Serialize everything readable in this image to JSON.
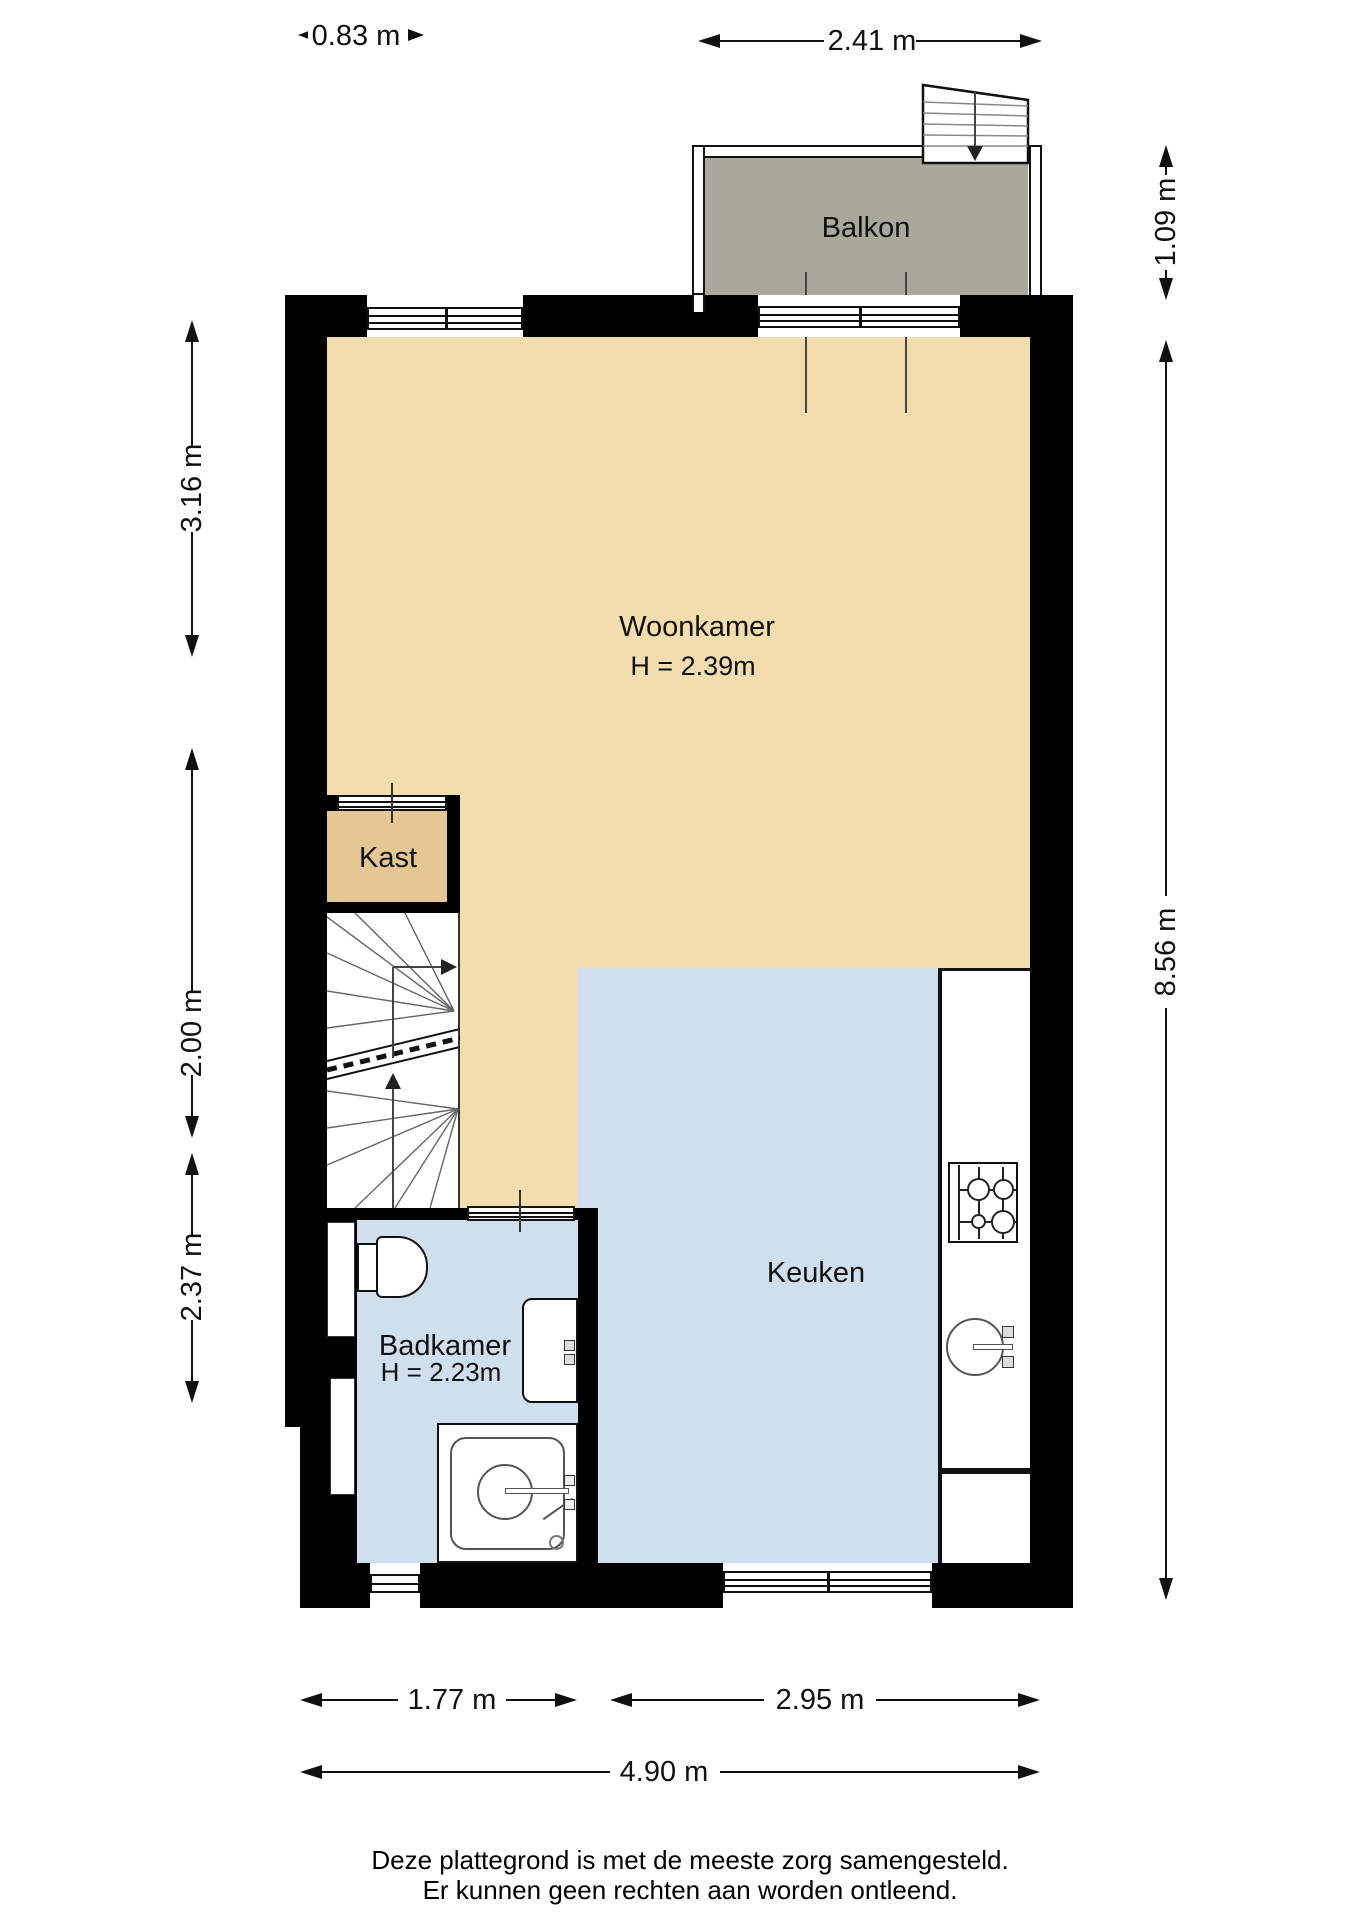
{
  "rooms": {
    "balkon": {
      "label": "Balkon"
    },
    "woonkamer": {
      "label": "Woonkamer",
      "ceiling_height": "H = 2.39m"
    },
    "kast": {
      "label": "Kast"
    },
    "keuken": {
      "label": "Keuken"
    },
    "badkamer": {
      "label": "Badkamer",
      "ceiling_height": "H = 2.23m"
    }
  },
  "dimensions": {
    "top_window_width": "0.83 m",
    "balcony_width": "2.41 m",
    "balcony_depth": "1.09 m",
    "left_upper": "3.16 m",
    "left_middle": "2.00 m",
    "left_lower": "2.37 m",
    "total_height": "8.56 m",
    "bottom_left": "1.77 m",
    "bottom_right": "2.95 m",
    "total_width": "4.90 m"
  },
  "footer": {
    "line1": "Deze plattegrond is met de meeste zorg samengesteld.",
    "line2": "Er kunnen geen rechten aan worden ontleend."
  },
  "colors": {
    "wall": "#000000",
    "living_floor": "#f3ddae",
    "kast_floor": "#e5c795",
    "wet_floor": "#cfdfee",
    "balcony_floor": "#a8a99b"
  }
}
